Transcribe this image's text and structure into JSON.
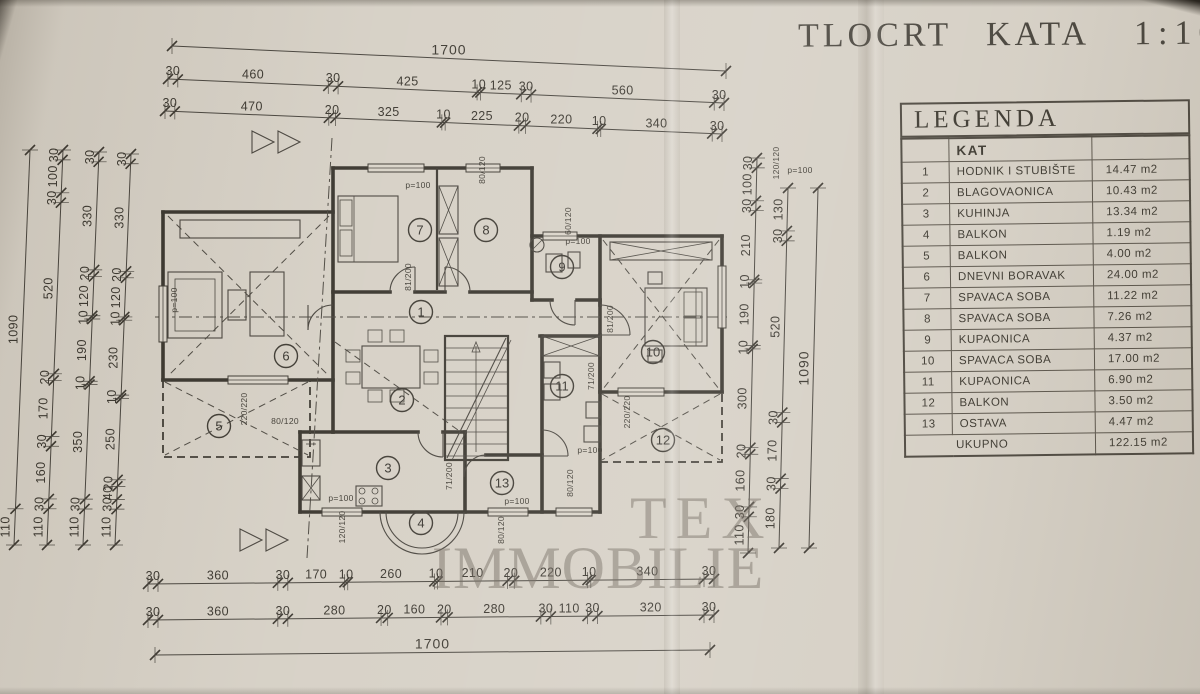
{
  "page": {
    "title": "TLOCRT KATA",
    "scale": "1:100",
    "watermark_line1": "TEX",
    "watermark_line2": "IMMOBILIE"
  },
  "colors": {
    "paper": "#d5cfc4",
    "ink": "#3b372f",
    "watermark": "rgba(106,98,88,0.48)"
  },
  "legend": {
    "title": "LEGENDA",
    "column_header": "KAT",
    "rows": [
      {
        "num": "1",
        "name": "HODNIK I STUBIŠTE",
        "area": "14.47 m2"
      },
      {
        "num": "2",
        "name": "BLAGOVAONICA",
        "area": "10.43 m2"
      },
      {
        "num": "3",
        "name": "KUHINJA",
        "area": "13.34 m2"
      },
      {
        "num": "4",
        "name": "BALKON",
        "area": "1.19 m2"
      },
      {
        "num": "5",
        "name": "BALKON",
        "area": "4.00 m2"
      },
      {
        "num": "6",
        "name": "DNEVNI BORAVAK",
        "area": "24.00 m2"
      },
      {
        "num": "7",
        "name": "SPAVACA SOBA",
        "area": "11.22 m2"
      },
      {
        "num": "8",
        "name": "SPAVACA SOBA",
        "area": "7.26 m2"
      },
      {
        "num": "9",
        "name": "KUPAONICA",
        "area": "4.37 m2"
      },
      {
        "num": "10",
        "name": "SPAVACA SOBA",
        "area": "17.00 m2"
      },
      {
        "num": "11",
        "name": "KUPAONICA",
        "area": "6.90 m2"
      },
      {
        "num": "12",
        "name": "BALKON",
        "area": "3.50 m2"
      },
      {
        "num": "13",
        "name": "OSTAVA",
        "area": "4.47 m2"
      }
    ],
    "total_label": "UKUPNO",
    "total_area": "122.15 m2"
  },
  "dimensions": {
    "top": [
      [
        "1700"
      ],
      [
        "30",
        "460",
        "30",
        "425",
        "10",
        "125",
        "30",
        "560",
        "30"
      ],
      [
        "30",
        "470",
        "20",
        "325",
        "10",
        "225",
        "20",
        "220",
        "10",
        "340",
        "30"
      ]
    ],
    "bottom": [
      [
        "30",
        "360",
        "30",
        "170",
        "10",
        "260",
        "10",
        "210",
        "20",
        "220",
        "10",
        "340",
        "30"
      ],
      [
        "30",
        "360",
        "30",
        "280",
        "20",
        "160",
        "20",
        "280",
        "30",
        "110",
        "30",
        "320",
        "30"
      ],
      [
        "1700"
      ]
    ],
    "left": [
      [
        "1090",
        "110"
      ],
      [
        "30",
        "100",
        "30",
        "520",
        "20",
        "170",
        "30",
        "160",
        "30",
        "110"
      ],
      [
        "30",
        "330",
        "20",
        "120",
        "10",
        "190",
        "10",
        "350",
        "30",
        "110"
      ],
      [
        "30",
        "330",
        "20",
        "120",
        "10",
        "230",
        "10",
        "250",
        "20",
        "40",
        "30",
        "110"
      ]
    ],
    "right": [
      [
        "30",
        "100",
        "30",
        "210",
        "10",
        "190",
        "10",
        "300",
        "20",
        "160",
        "30",
        "110"
      ],
      [
        "130",
        "30",
        "520",
        "30",
        "170",
        "30",
        "180"
      ],
      [
        "1090"
      ]
    ]
  },
  "plan_labels": {
    "parapet": "p=100",
    "window_120x120": "120/120",
    "window_80x120": "80/120",
    "window_60x120": "60/120",
    "window_220x220": "220/220",
    "door_81x200": "81/200",
    "door_71x200": "71/200"
  }
}
